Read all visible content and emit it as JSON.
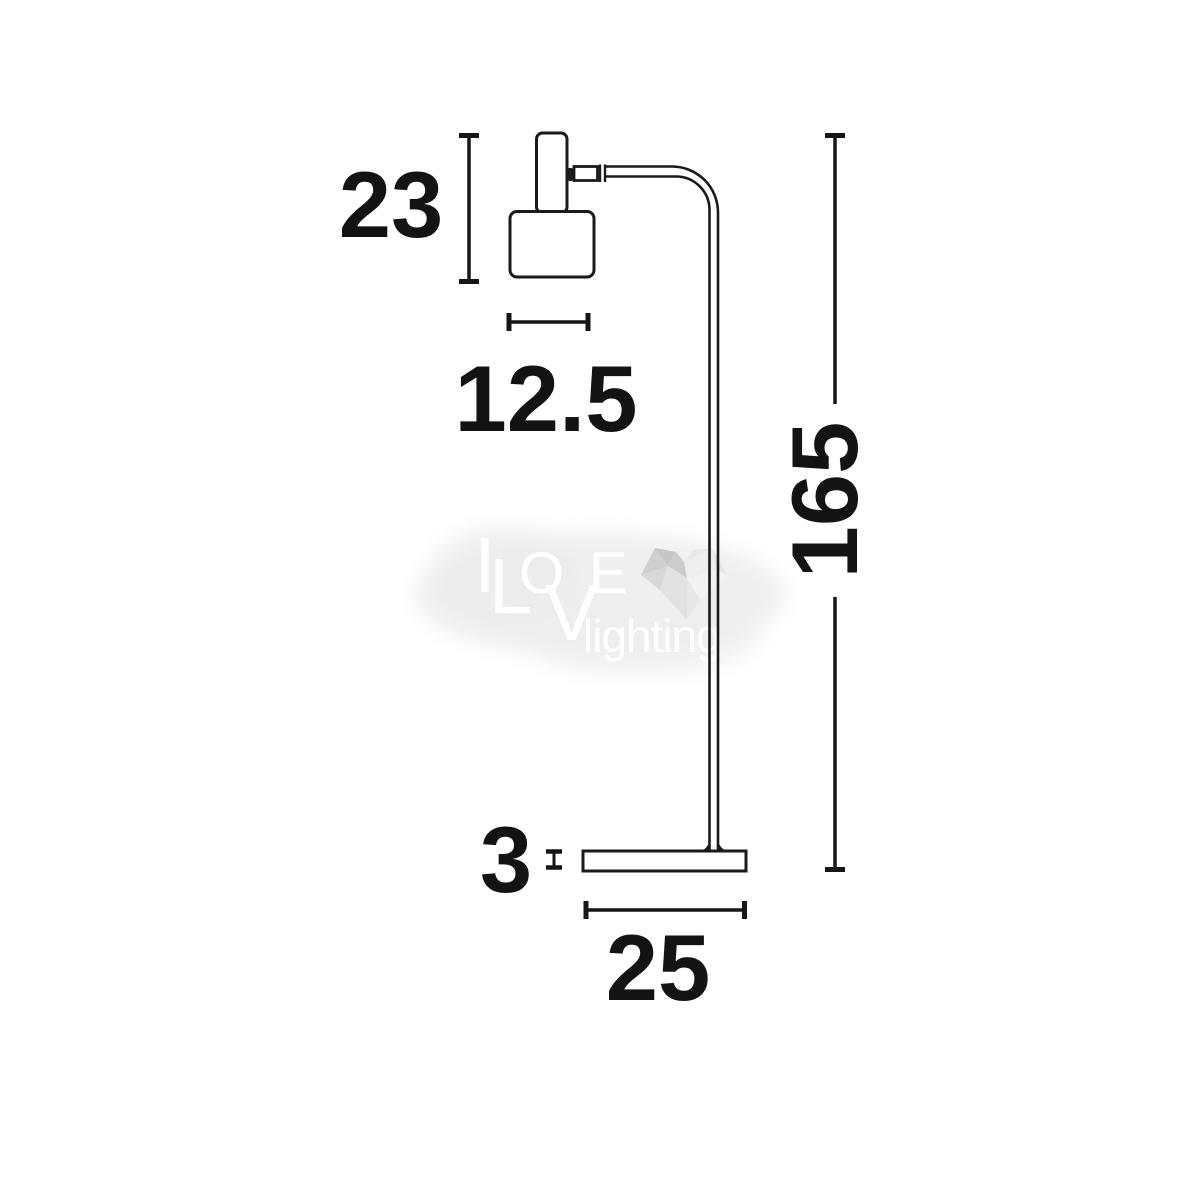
{
  "page": {
    "background": "#ffffff"
  },
  "drawing": {
    "subject": "floor-lamp-technical-line-drawing",
    "line_color": "#1a1a1a",
    "label_color": "#131313",
    "dimensions": [
      {
        "id": "head-height",
        "value": "23",
        "orientation": "vertical"
      },
      {
        "id": "shade-width",
        "value": "12.5",
        "orientation": "horizontal"
      },
      {
        "id": "total-height",
        "value": "165",
        "orientation": "vertical-rotated"
      },
      {
        "id": "base-thickness",
        "value": "3",
        "orientation": "vertical"
      },
      {
        "id": "base-width",
        "value": "25",
        "orientation": "horizontal"
      }
    ]
  },
  "watermark": {
    "letters": {
      "i": "I",
      "l": "L",
      "o": "O",
      "v": "V",
      "e": "E"
    },
    "subtitle": "lighting",
    "icon": "low-poly-heart-icon",
    "text_color": "#ffffff",
    "glow_color": "#ececec",
    "heart_shades": [
      "#c6c6c6",
      "#d4d4d4",
      "#e2e2e2",
      "#eeeeee",
      "#f2f2f2"
    ]
  }
}
